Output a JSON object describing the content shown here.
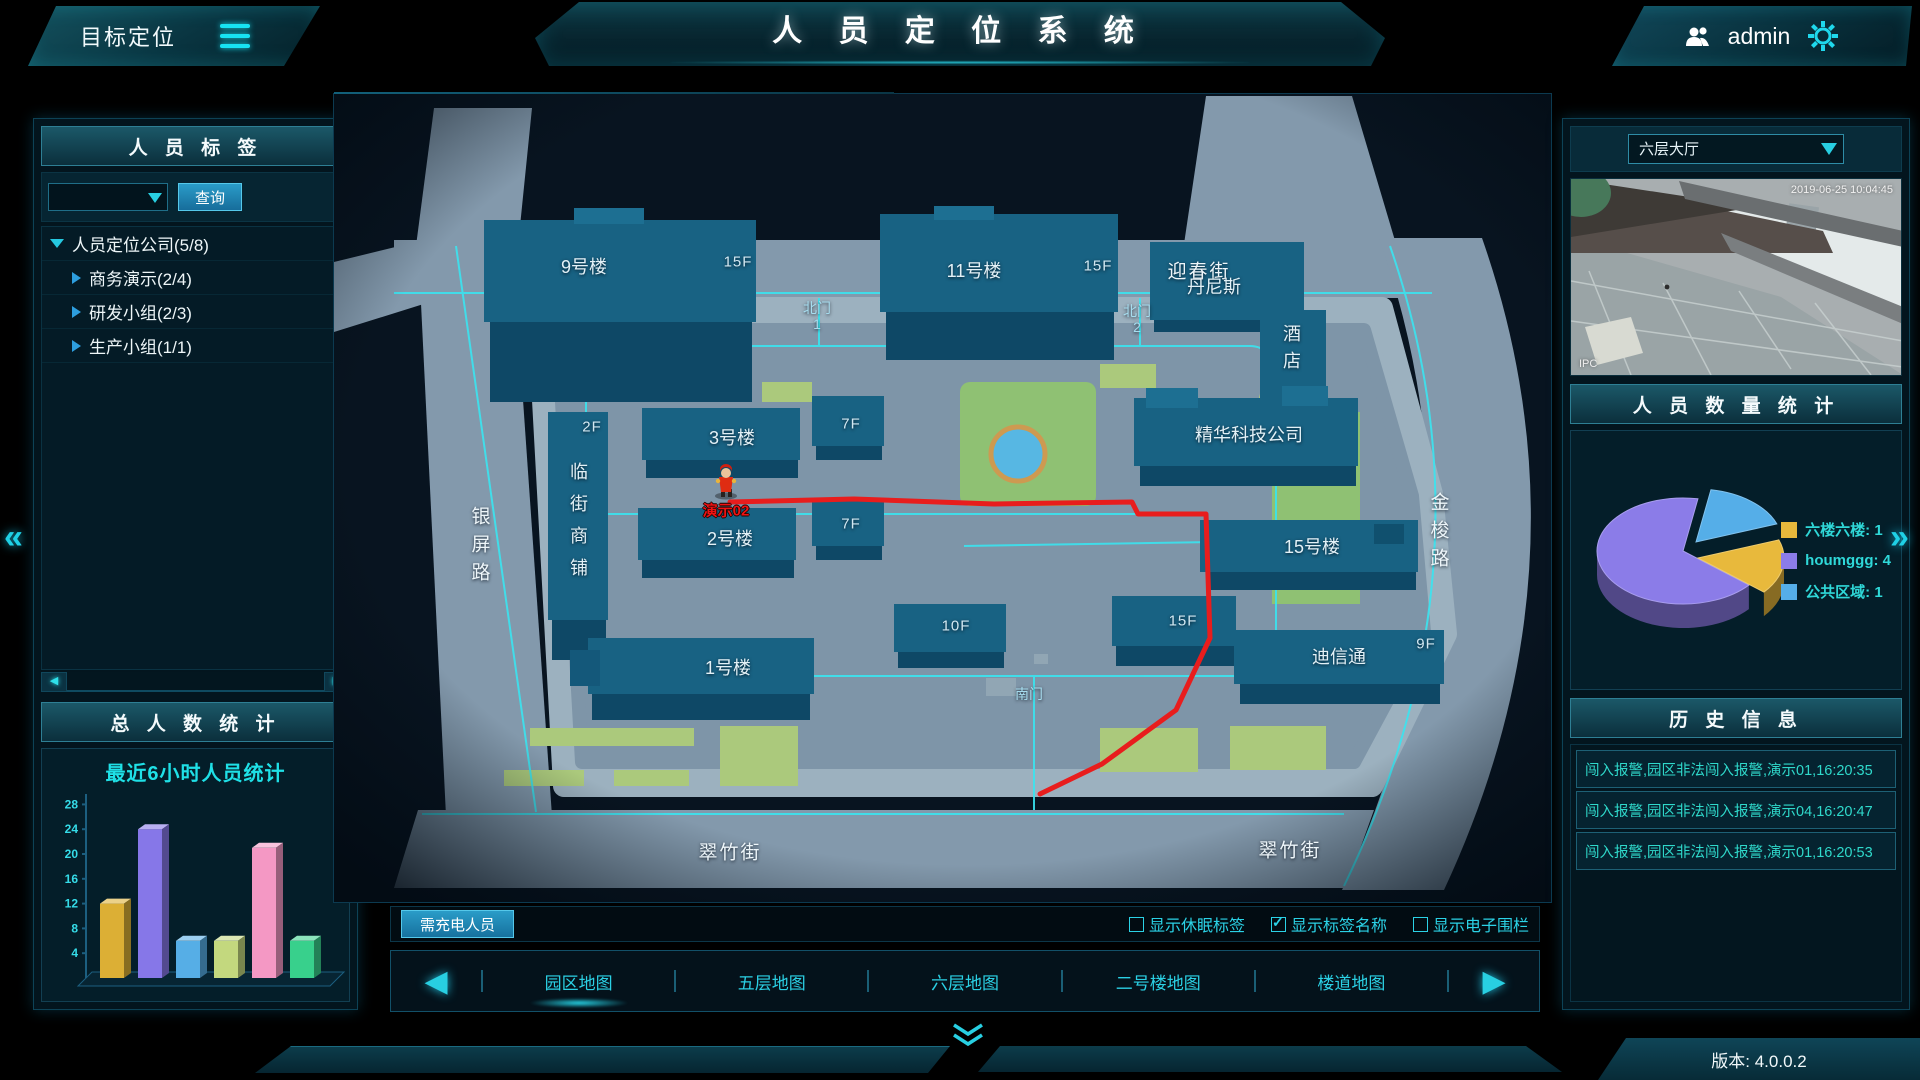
{
  "header": {
    "menu_title": "目标定位",
    "system_title": "人 员 定 位 系 统",
    "user": "admin"
  },
  "icons": {
    "prev": "◀",
    "next": "▶",
    "scroll_left": "◀",
    "scroll_right": "▶",
    "collapse_left": "«",
    "collapse_right": "»"
  },
  "left_panel": {
    "tags_header": "人 员 标 签",
    "search_value": "",
    "search_button": "查询",
    "tree": [
      {
        "label": "人员定位公司(5/8)",
        "level": 0,
        "expanded": true
      },
      {
        "label": "商务演示(2/4)",
        "level": 1,
        "expanded": false
      },
      {
        "label": "研发小组(2/3)",
        "level": 1,
        "expanded": false
      },
      {
        "label": "生产小组(1/1)",
        "level": 1,
        "expanded": false
      }
    ],
    "total_header": "总 人 数 统 计"
  },
  "chart_data": [
    {
      "type": "bar",
      "title": "最近6小时人员统计",
      "xlabel": "",
      "ylabel": "",
      "yticks": [
        4,
        8,
        12,
        16,
        20,
        24,
        28
      ],
      "ylim": [
        0,
        30
      ],
      "categories": [
        "",
        "",
        "",
        "",
        "",
        ""
      ],
      "values": [
        12,
        24,
        6,
        6,
        21,
        6
      ],
      "colors": [
        "#dcaf35",
        "#8677e8",
        "#56aee6",
        "#c3d87e",
        "#f498c4",
        "#38d08c"
      ],
      "grid": false,
      "legend_position": "none"
    },
    {
      "type": "pie",
      "title": "人 员 数 量 统 计",
      "slices": [
        {
          "label": "六楼六楼",
          "value": 1,
          "color": "#e8b93c",
          "display": "六楼六楼: 1"
        },
        {
          "label": "houmggg",
          "value": 4,
          "color": "#8b7ce8",
          "display": "houmggg: 4"
        },
        {
          "label": "公共区域",
          "value": 1,
          "color": "#55aee8",
          "display": "公共区域: 1"
        }
      ],
      "legend_position": "right"
    }
  ],
  "map": {
    "labels": {
      "b9": "9号楼",
      "f15": "15F",
      "b11": "11号楼",
      "yingchun": "迎春街",
      "bei": "北门",
      "g1": "1",
      "g2": "2",
      "dennis": "丹尼斯",
      "hotel": "酒店",
      "jinghua": "精华科技公司",
      "b3": "3号楼",
      "f7": "7F",
      "b2": "2号楼",
      "f2": "2F",
      "shops": "临街商铺",
      "b1": "1号楼",
      "f10": "10F",
      "b15": "15号楼",
      "dixin": "迪信通",
      "f9": "9F",
      "jinsuo": "金梭路",
      "yinping": "银屏路",
      "cuizhu": "翠竹街",
      "south": "南门"
    },
    "marker": {
      "name": "演示02"
    }
  },
  "camera": {
    "location": "六层大厅",
    "timestamp": "2019-06-25 10:04:45",
    "watermark": "IPC"
  },
  "right_panel": {
    "count_header": "人 员 数 量 统 计",
    "history_header": "历 史 信 息",
    "history": [
      "闯入报警,园区非法闯入报警,演示01,16:20:35",
      "闯入报警,园区非法闯入报警,演示04,16:20:47",
      "闯入报警,园区非法闯入报警,演示01,16:20:53"
    ]
  },
  "bottom_bar": {
    "charge_button": "需充电人员",
    "checkboxes": [
      {
        "label": "显示休眠标签",
        "checked": false
      },
      {
        "label": "显示标签名称",
        "checked": true
      },
      {
        "label": "显示电子围栏",
        "checked": false
      }
    ],
    "tabs": [
      "园区地图",
      "五层地图",
      "六层地图",
      "二号楼地图",
      "楼道地图"
    ],
    "active_tab": "园区地图"
  },
  "footer": {
    "version": "版本: 4.0.0.2"
  }
}
